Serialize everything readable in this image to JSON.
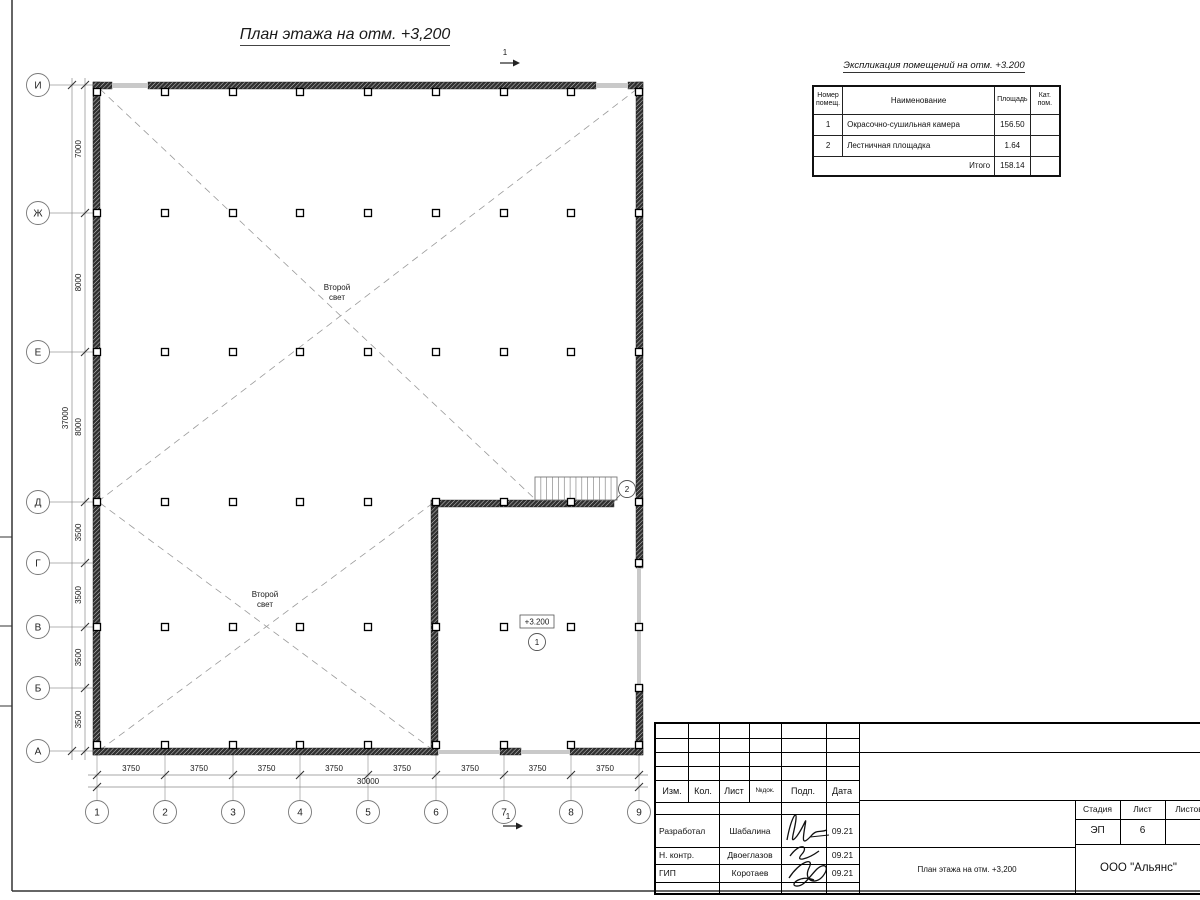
{
  "sheet": {
    "title": "План этажа на отм. +3,200",
    "section_mark_label": "1"
  },
  "plan": {
    "row_axes": [
      "И",
      "Ж",
      "Е",
      "Д",
      "Г",
      "В",
      "Б",
      "А"
    ],
    "col_axes": [
      "1",
      "2",
      "3",
      "4",
      "5",
      "6",
      "7",
      "8",
      "9"
    ],
    "dims_vertical": [
      "7000",
      "8000",
      "8000",
      "3500",
      "3500",
      "3500",
      "3500"
    ],
    "dim_total_vertical": "37000",
    "dims_horizontal": [
      "3750",
      "3750",
      "3750",
      "3750",
      "3750",
      "3750",
      "3750",
      "3750"
    ],
    "dim_total_horizontal": "30000",
    "second_light": {
      "line1": "Второй",
      "line2": "свет"
    },
    "elevation_mark": "+3.200",
    "room1_number": "1",
    "room2_number": "2"
  },
  "explication": {
    "title": "Экспликация помещений на отм. +3.200",
    "headers": {
      "number": "Номер помещ.",
      "name": "Наименование",
      "area": "Площадь",
      "category": "Кат. пом."
    },
    "rows": [
      {
        "number": "1",
        "name": "Окрасочно-сушильная камера",
        "area": "156.50",
        "category": ""
      },
      {
        "number": "2",
        "name": "Лестничная площадка",
        "area": "1.64",
        "category": ""
      }
    ],
    "total_label": "Итого",
    "total_area": "158.14"
  },
  "titleblock": {
    "columns": [
      "Изм.",
      "Кол.",
      "Лист",
      "№док.",
      "Подп.",
      "Дата"
    ],
    "signature_rows": [
      {
        "role": "Разработал",
        "name": "Шабалина",
        "date": "09.21"
      },
      {
        "role": "Н. контр.",
        "name": "Двоеглазов",
        "date": "09.21"
      },
      {
        "role": "ГИП",
        "name": "Коротаев",
        "date": "09.21"
      }
    ],
    "doc_title": "План этажа на отм. +3,200",
    "stage_label": "Стадия",
    "sheet_label": "Лист",
    "sheets_label": "Листов",
    "stage_value": "ЭП",
    "sheet_value": "6",
    "company": "ООО \"Альянс\""
  }
}
